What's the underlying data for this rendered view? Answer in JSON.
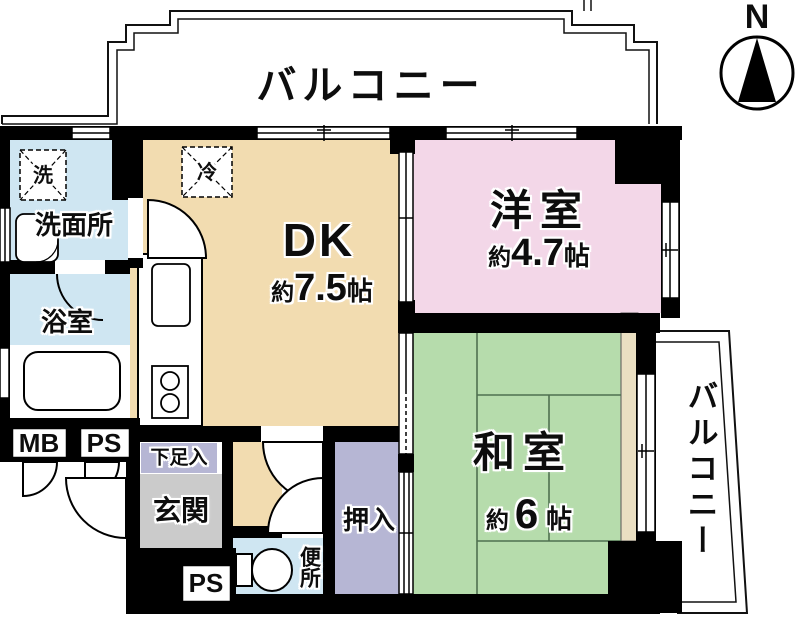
{
  "plan": {
    "balcony_top_label": "バルコニー",
    "balcony_right_label": "バルコニー",
    "compass_label": "N",
    "rooms": {
      "dk": {
        "name": "DK",
        "area_prefix": "約",
        "area_value": "7.5",
        "area_unit": "帖"
      },
      "western_room": {
        "name": "洋室",
        "area_prefix": "約",
        "area_value": "4.7",
        "area_unit": "帖"
      },
      "japanese_room": {
        "name": "和室",
        "area_prefix": "約",
        "area_value": "6",
        "area_unit": "帖"
      },
      "washroom": {
        "name": "洗面所"
      },
      "bathroom": {
        "name": "浴室"
      },
      "toilet": {
        "name": "便所"
      },
      "entrance": {
        "name": "玄関"
      },
      "shoe_cabinet": {
        "name": "下足入"
      },
      "closet": {
        "name": "押入"
      }
    },
    "fixtures": {
      "washing_machine": "洗",
      "refrigerator": "冷"
    },
    "utility": {
      "meter_box": "MB",
      "pipe_space_left": "PS",
      "pipe_space_bottom": "PS"
    },
    "colors": {
      "wall": "#000000",
      "water_rooms": "#cfe6f2",
      "dk_floor": "#f2dcb0",
      "western_room": "#f3d7e8",
      "japanese_room": "#b6dcac",
      "closet": "#b6b6d4",
      "entrance_floor": "#cbcbcb",
      "tatami_edge": "#eadfc2"
    }
  }
}
